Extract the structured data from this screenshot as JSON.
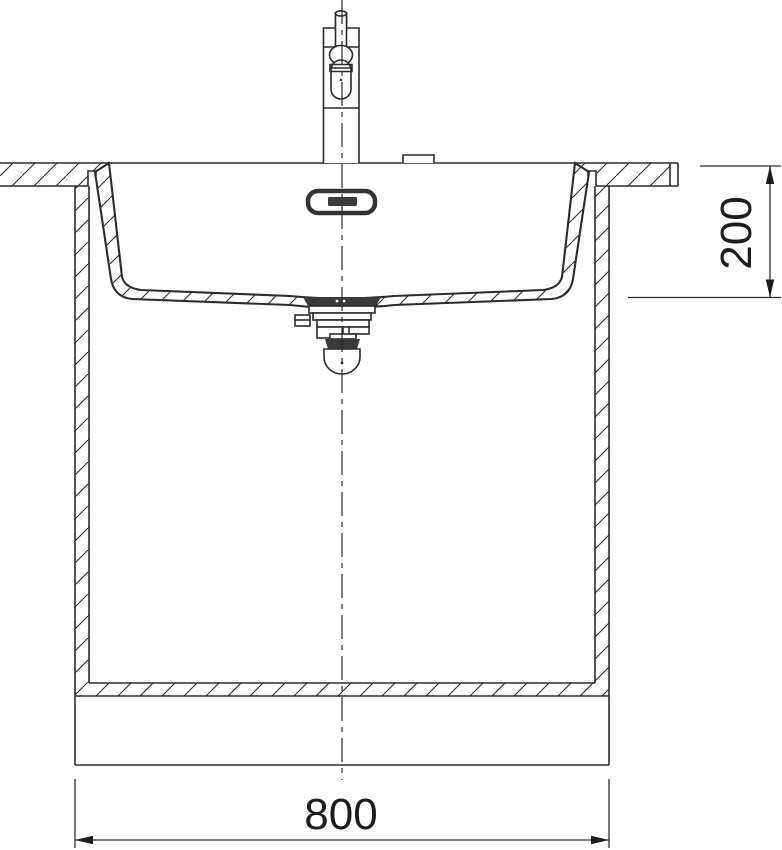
{
  "drawing": {
    "kind": "technical-cross-section",
    "subject": "undermount kitchen sink with single-lever tap, countertop and base cabinet, front section view"
  },
  "dimensions": {
    "width": "800",
    "depth": "200"
  },
  "colors": {
    "line": "#2b2b2b",
    "dark_fill": "#3a3a3a",
    "background": "#ffffff"
  }
}
